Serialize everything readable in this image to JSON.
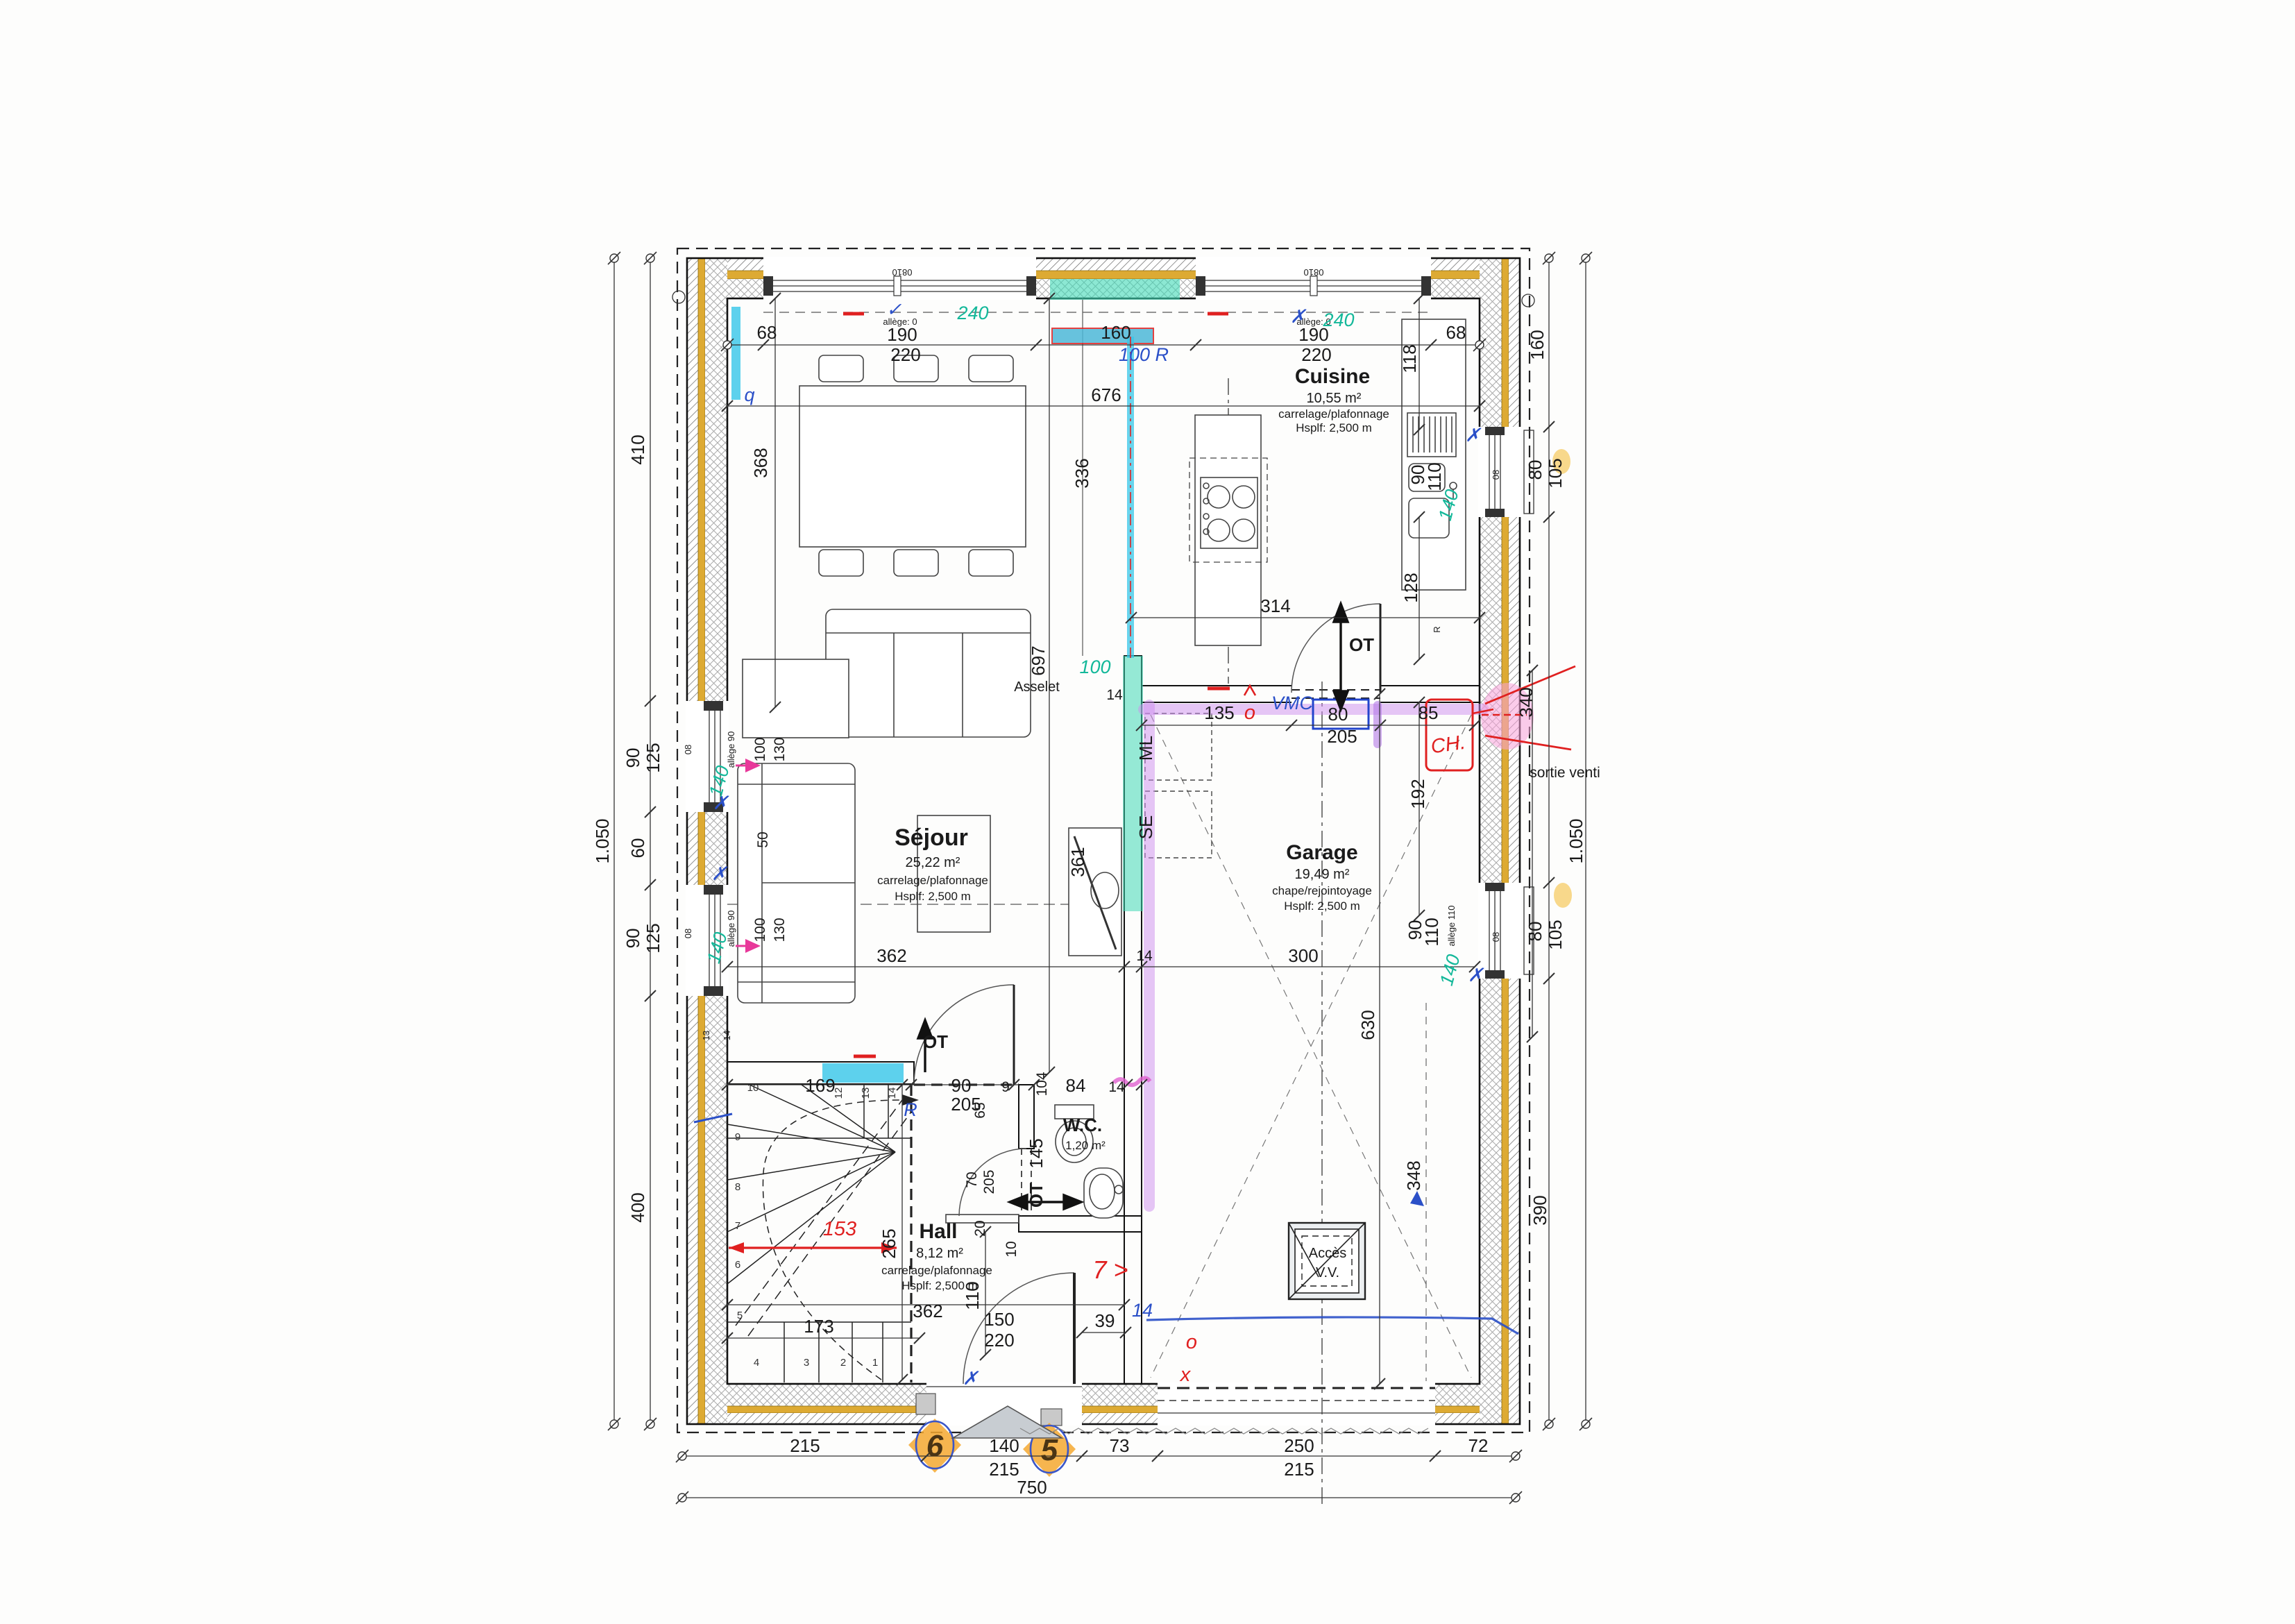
{
  "rooms": {
    "cuisine": {
      "name": "Cuisine",
      "area": "10,55 m²",
      "finish": "carrelage/plafonnage",
      "height": "Hsplf: 2,500 m"
    },
    "sejour": {
      "name": "Séjour",
      "area": "25,22 m²",
      "finish": "carrelage/plafonnage",
      "height": "Hsplf: 2,500 m"
    },
    "garage": {
      "name": "Garage",
      "area": "19,49 m²",
      "finish": "chape/rejointoyage",
      "height": "Hsplf: 2,500 m"
    },
    "hall": {
      "name": "Hall",
      "area": "8,12 m²",
      "finish": "carrelage/plafonnage",
      "height": "Hsplf: 2,500 m"
    },
    "wc": {
      "name": "W.C.",
      "area": "1,20 m²"
    },
    "acces": {
      "line1": "Accès",
      "line2": "V.V."
    }
  },
  "labels": {
    "asselet": "Asselet",
    "ml": "ML",
    "se": "SE",
    "ot": "OT",
    "ot_num": "145",
    "sortie_venti": "sortie venti",
    "allege0": "allège: 0",
    "allege90": "allège 90",
    "allege110": "allège 110",
    "w0810": "0810",
    "ob": "08",
    "r": "R"
  },
  "dims": {
    "n68": "68",
    "n190": "190",
    "n220": "220",
    "n160": "160",
    "n676": "676",
    "n240": "240",
    "n410": "410",
    "n400": "400",
    "n1050": "1.050",
    "n90": "90",
    "n125": "125",
    "n60": "60",
    "n368": "368",
    "n362": "362",
    "n336": "336",
    "n697": "697",
    "n100": "100",
    "n130": "130",
    "n50": "50",
    "n314": "314",
    "n118": "118",
    "n128": "128",
    "n110": "110",
    "n80": "80",
    "n105": "105",
    "n205": "205",
    "n135": "135",
    "n85": "85",
    "n14": "14",
    "n13": "13",
    "n104": "104",
    "n9": "9",
    "n10": "10",
    "n84": "84",
    "n65": "65",
    "n70": "70",
    "n20": "20",
    "n145": "145",
    "n150": "150",
    "n39": "39",
    "n169": "169",
    "n265": "265",
    "n173": "173",
    "n215": "215",
    "n140": "140",
    "n73": "73",
    "n250": "250",
    "n72": "72",
    "n750": "750",
    "n192": "192",
    "n300": "300",
    "n630": "630",
    "n348": "348",
    "n340": "340",
    "n390": "390",
    "n361": "361"
  },
  "annotations": {
    "a240": "240",
    "a140": "140",
    "a100": "100",
    "a100r": "100 R",
    "vmc": "VMC",
    "ch": "CH.",
    "a153": "153",
    "a7": "7 >",
    "ao": "o",
    "ax": "x",
    "aq": "q",
    "ar": "R",
    "a14": "14",
    "a6": "6",
    "a5": "5",
    "check": "✓",
    "cross": "✗"
  },
  "steps": {
    "s1": "1",
    "s2": "2",
    "s3": "3",
    "s4": "4",
    "s5": "5",
    "s6": "6",
    "s7": "7",
    "s8": "8",
    "s9": "9",
    "s10": "10",
    "s12": "12",
    "s13": "13",
    "s14": "14"
  },
  "colors": {
    "insulation_gold": "#ddaa33",
    "wall_yellow": "#f0ef8a",
    "teal_highlight": "#3fd9b5",
    "cyan_highlight": "#35c5e8",
    "violet_highlight": "#cf8ef0",
    "magenta_pen": "#e0389a",
    "red_pen": "#e02020",
    "blue_pen": "#2b50c8",
    "teal_pen": "#14b89a",
    "orange_highlight": "#f5a830"
  }
}
